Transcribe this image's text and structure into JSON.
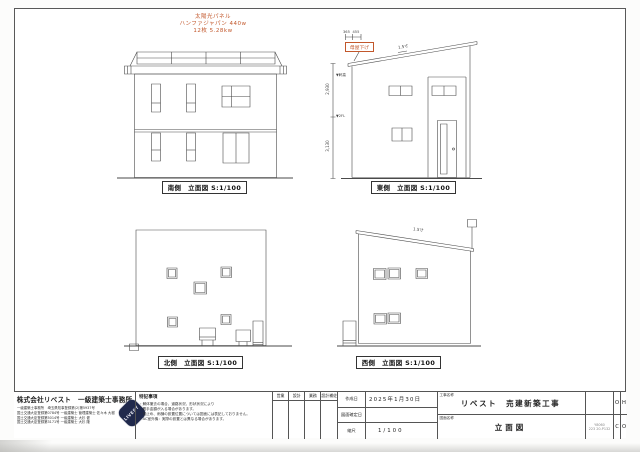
{
  "annotations": {
    "solar_line1": "太陽光パネル",
    "solar_line2": "ハンファジャパン 440w",
    "solar_line3": "12枚 5.28kw",
    "moyasage": "母屋下げ",
    "dim_top_left": "365",
    "dim_top_right": "455",
    "pitch_east": "1.5寸",
    "pitch_west": "1.5寸",
    "vdim_upper": "2,930",
    "vdim_lower": "3,130",
    "level_upper": "▼軒高",
    "level_lower": "▼2FL",
    "accent_color": "#c2572b"
  },
  "views": {
    "south_label": "南側　立面図 S:1/100",
    "east_label": "東側　立面図 S:1/100",
    "north_label": "北側　立面図 S:1/100",
    "west_label": "西側　立面図 S:1/100"
  },
  "titleblock": {
    "company_name": "株式会社リベスト　一級建築士事務所",
    "company_line1": "一級建築士事務所　埼玉県知事登録第(2)第5937号",
    "company_line2": "国土交通大臣登録第0784号 一級建築士 管理建築士 佐々木 大樹",
    "company_line3": "国土交通大臣登録第5014号 一級建築士 大杉 健",
    "company_line4": "国土交通大臣登録第3171号 一級建築士 大杉 隆",
    "logo_text": "LIVEST",
    "notes_title": "特記事項",
    "note1": "・解体撤去の場合、道路状況、形状状況により",
    "note2": "　着手金額が入る場合があります。",
    "note3": "・雪止め、雨樋の設置位置については図面には表記しておりません。",
    "note4": "・AC室外機：実際の設置とは異なる場合があります。",
    "approval_h1": "営業",
    "approval_h2": "設計",
    "approval_h3": "業務",
    "approval_h4": "設計補佐",
    "date_label": "作成日",
    "date_value": "2025年1月30日",
    "fix_label": "図面確定日",
    "fix_value": "",
    "scale_label": "縮尺",
    "scale_value": "1/100",
    "project_label": "工事名称",
    "project_name": "リベスト　売建新築工事",
    "drawing_label": "図面名称",
    "drawing_name": "立面図",
    "code_line1": "Y8060",
    "code_line2": "223 20-P132",
    "corner_tl": "O",
    "corner_tr": "H",
    "corner_bl": "C",
    "corner_br": "O"
  }
}
